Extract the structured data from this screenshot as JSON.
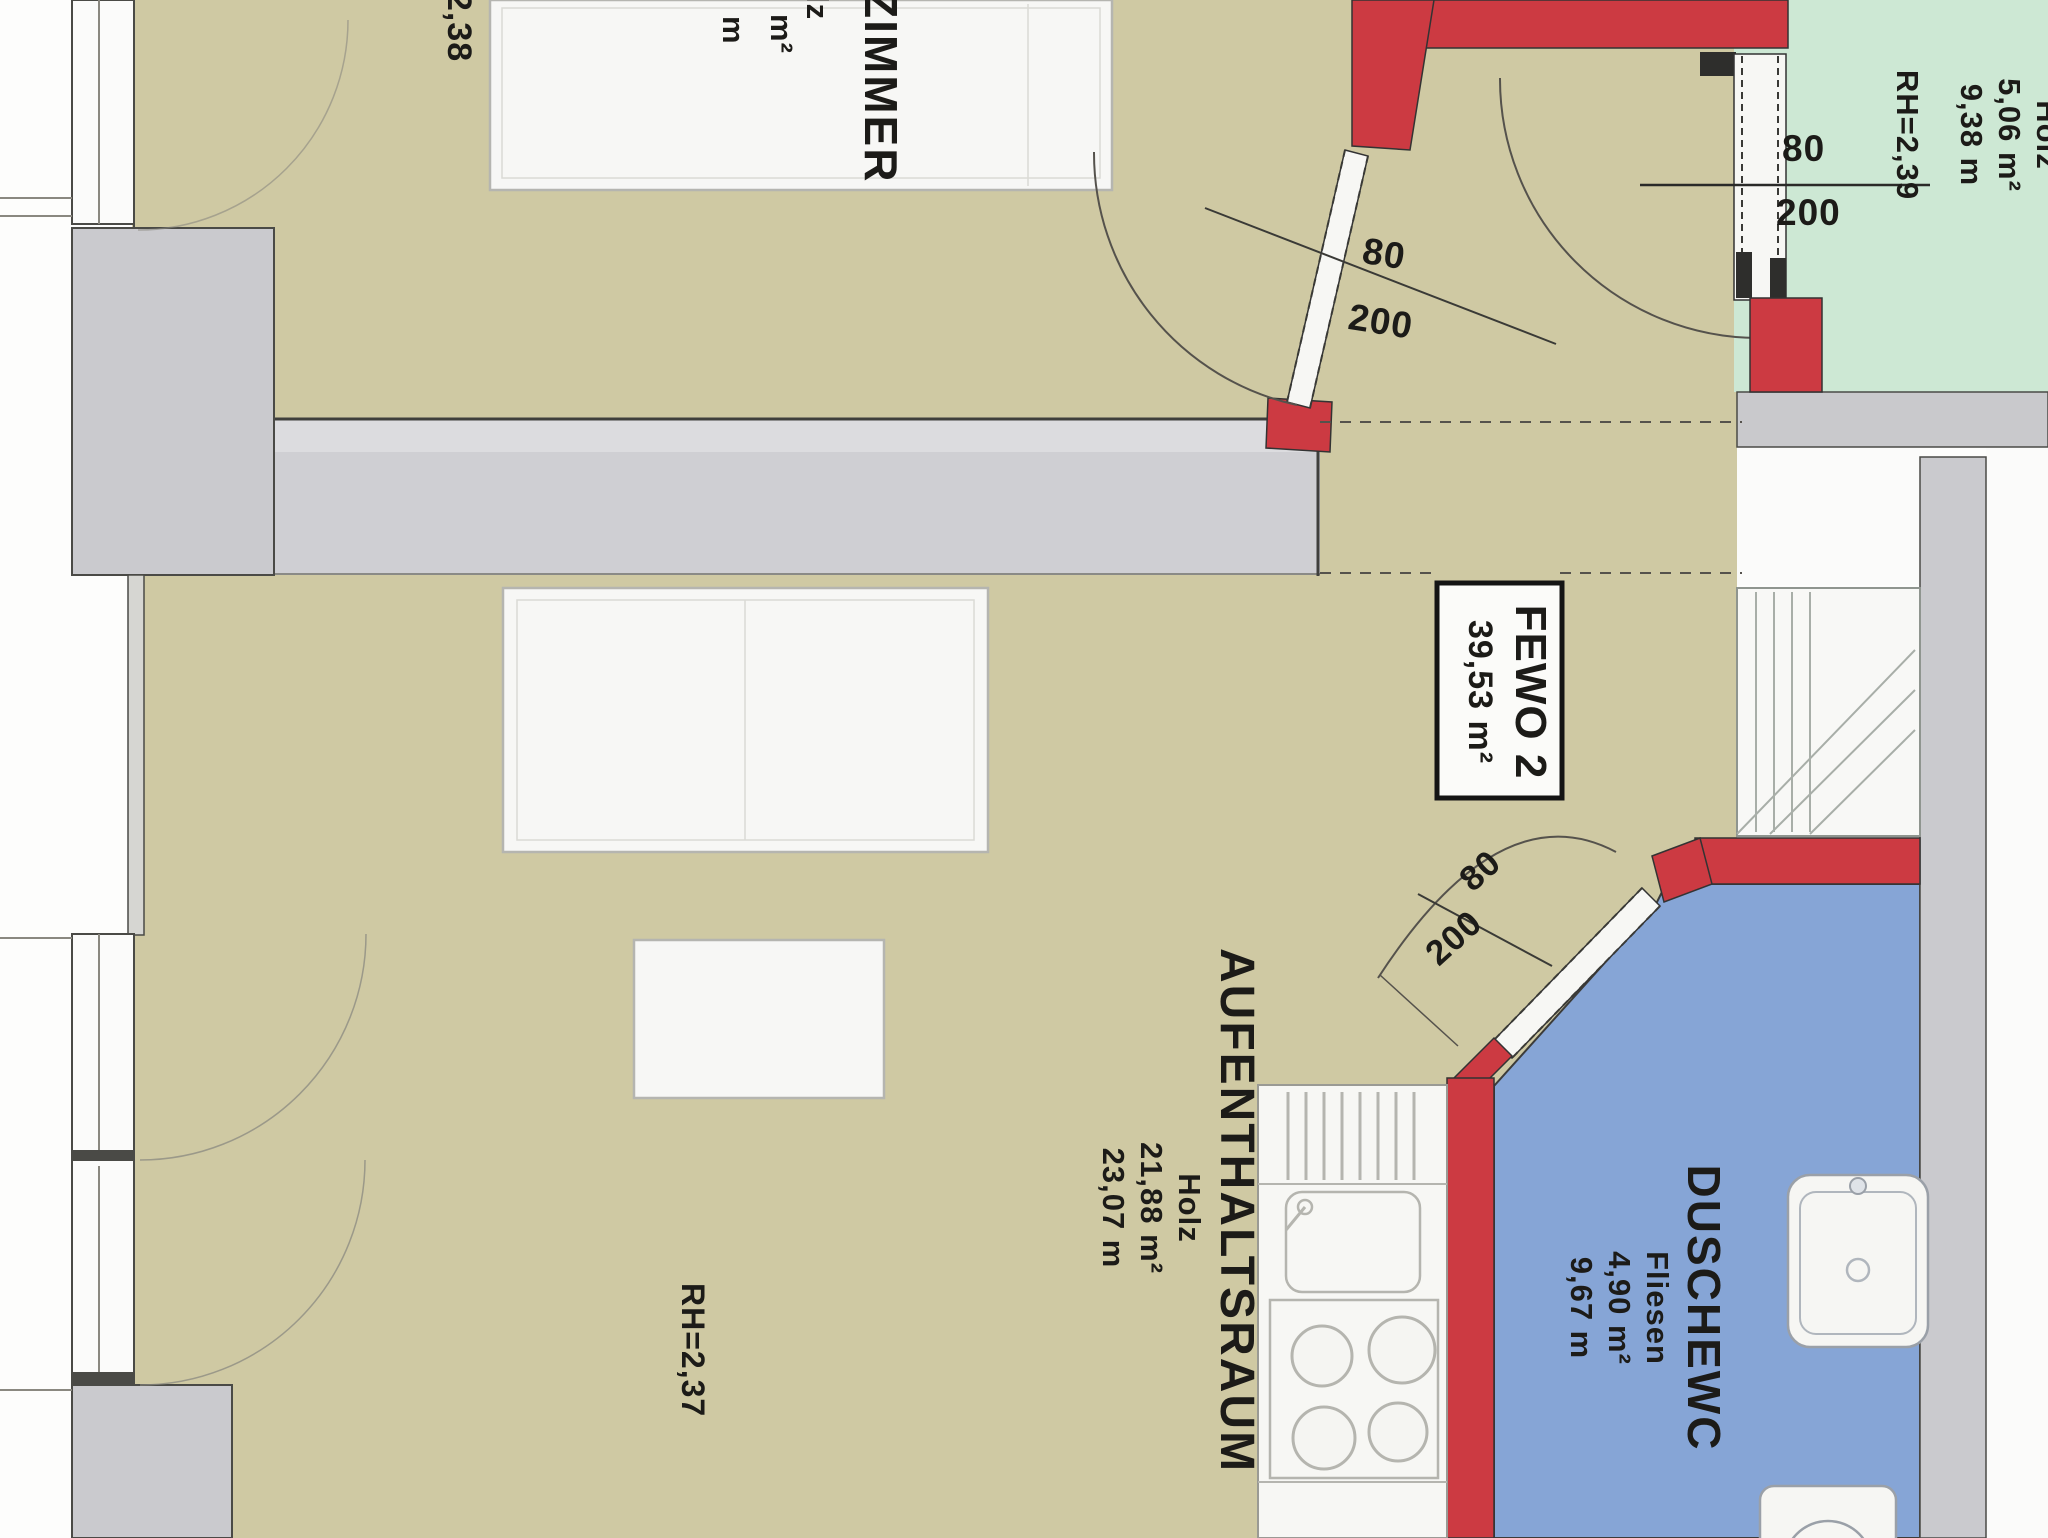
{
  "unit": {
    "box_line1": "FEWO 2",
    "box_line2": "39,53 m²"
  },
  "rooms": {
    "zimmer": {
      "name": "ZIMMER",
      "material_fragment": "lz",
      "area_fragment": "m²",
      "perimeter_fragment": "m",
      "rh_fragment": "2,38"
    },
    "aufenthaltsraum": {
      "name": "AUFENTHALTSRAUM",
      "material": "Holz",
      "area": "21,88 m²",
      "perimeter": "23,07 m",
      "rh": "RH=2,37"
    },
    "dusche_wc": {
      "name": "DUSCHEWC",
      "material": "Fliesen",
      "area": "4,90 m²",
      "perimeter": "9,67 m"
    },
    "top_right_room": {
      "material_fragment": "Holz",
      "area": "5,06 m²",
      "perimeter": "9,38 m",
      "rh": "RH=2,39"
    }
  },
  "doors": {
    "zimmer_door": {
      "width": "80",
      "height": "200"
    },
    "top_right_door": {
      "width": "80",
      "height": "200"
    },
    "bath_door": {
      "width": "80",
      "height": "200"
    }
  },
  "colors": {
    "floor_wood": "#cfc9a3",
    "floor_green": "#cde8d4",
    "floor_tile_blue": "#86a5d6",
    "wall_red": "#cc3a42",
    "wall_gray": "#cccccf",
    "furniture_white": "#f7f7f4",
    "line_dark": "#44443f"
  }
}
